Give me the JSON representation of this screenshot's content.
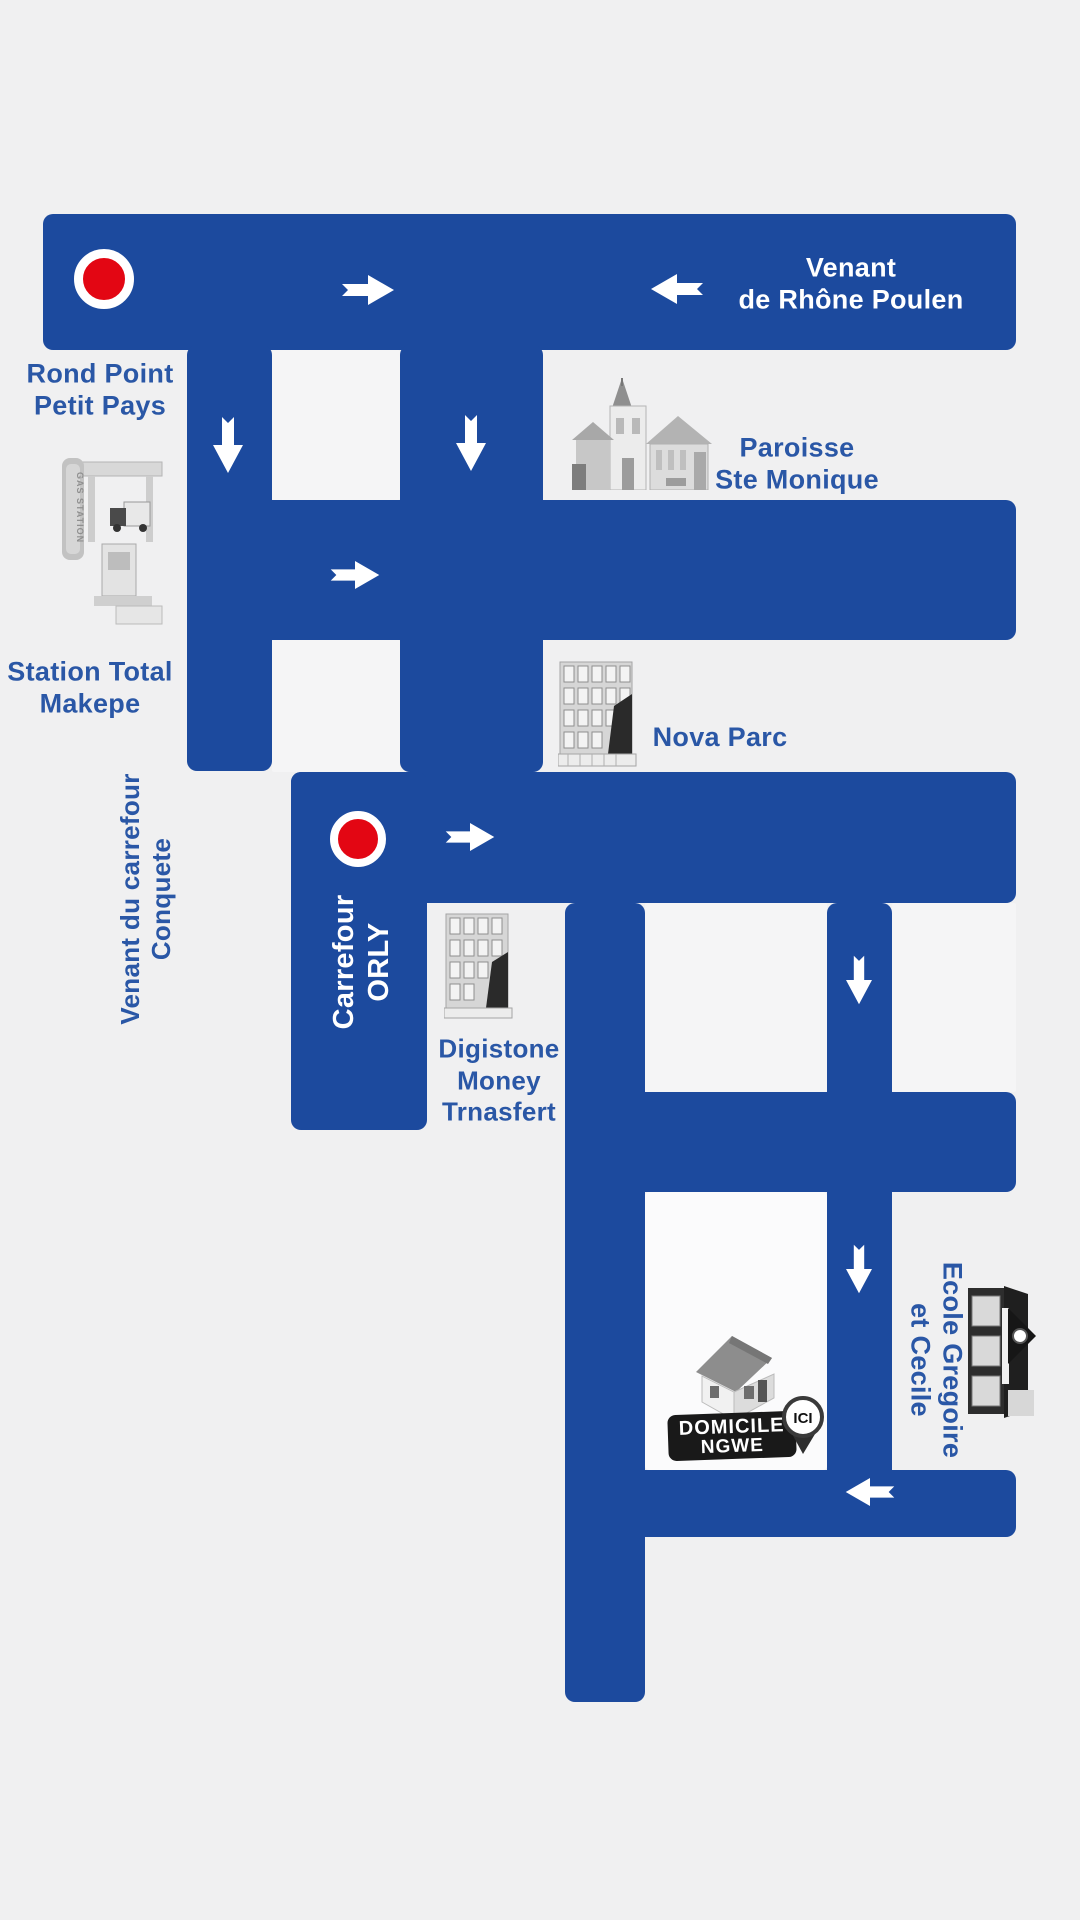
{
  "colors": {
    "background": "#f0f0f1",
    "road": "#1c4a9e",
    "label": "#2a57a6",
    "road_text": "#ffffff",
    "marker_red": "#e30613",
    "badge_bg": "#191919"
  },
  "labels": {
    "venant_rhone_line1": "Venant",
    "venant_rhone_line2": "de Rhône Poulen",
    "rond_point_line1": "Rond Point",
    "rond_point_line2": "Petit Pays",
    "station_line1": "Station Total",
    "station_line2": "Makepe",
    "paroisse_line1": "Paroisse",
    "paroisse_line2": "Ste Monique",
    "nova_parc": "Nova Parc",
    "venant_conquete_line1": "Venant du carrefour",
    "venant_conquete_line2": "Conquete",
    "carrefour_orly_line1": "Carrefour",
    "carrefour_orly_line2": "ORLY",
    "digistone_line1": "Digistone",
    "digistone_line2": "Money",
    "digistone_line3": "Trnasfert",
    "ecole_line1": "Ecole Gregoire",
    "ecole_line2": "et Cecile",
    "domicile_line1": "DOMICILE",
    "domicile_line2": "NGWE",
    "ici": "ICI",
    "gas_station_sign": "GAS STATION"
  },
  "icons": {
    "roundabout_marker": "red-dot-in-white-ring",
    "direction_arrow": "white-block-arrow",
    "landmarks": [
      "gas-station",
      "church",
      "office-building",
      "office-building",
      "school-building",
      "house"
    ]
  }
}
